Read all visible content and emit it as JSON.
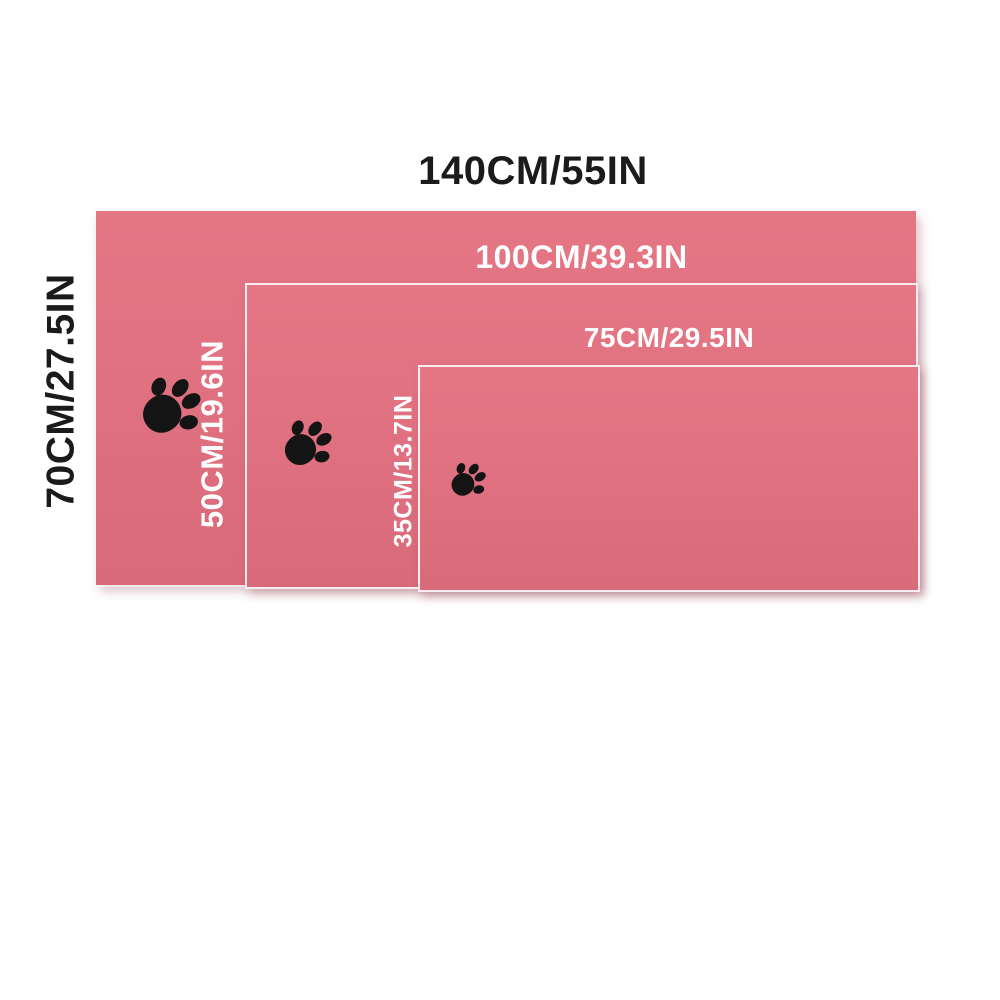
{
  "colors": {
    "background": "#ffffff",
    "blanket_top": "#e57684",
    "blanket_mid": "#df7080",
    "blanket_bottom": "#d86a7a",
    "label_dark": "#1b1b1b",
    "label_light": "#ffffff",
    "paw": "#141414"
  },
  "sizes": [
    {
      "id": "large",
      "width_label": "140CM/55IN",
      "height_label": "70CM/27.5IN",
      "width_cm": 140,
      "width_in": 55,
      "height_cm": 70,
      "height_in": 27.5,
      "icon": "paw-print"
    },
    {
      "id": "medium",
      "width_label": "100CM/39.3IN",
      "height_label": "50CM/19.6IN",
      "width_cm": 100,
      "width_in": 39.3,
      "height_cm": 50,
      "height_in": 19.6,
      "icon": "paw-print"
    },
    {
      "id": "small",
      "width_label": "75CM/29.5IN",
      "height_label": "35CM/13.7IN",
      "width_cm": 75,
      "width_in": 29.5,
      "height_cm": 35,
      "height_in": 13.7,
      "icon": "paw-print"
    }
  ]
}
